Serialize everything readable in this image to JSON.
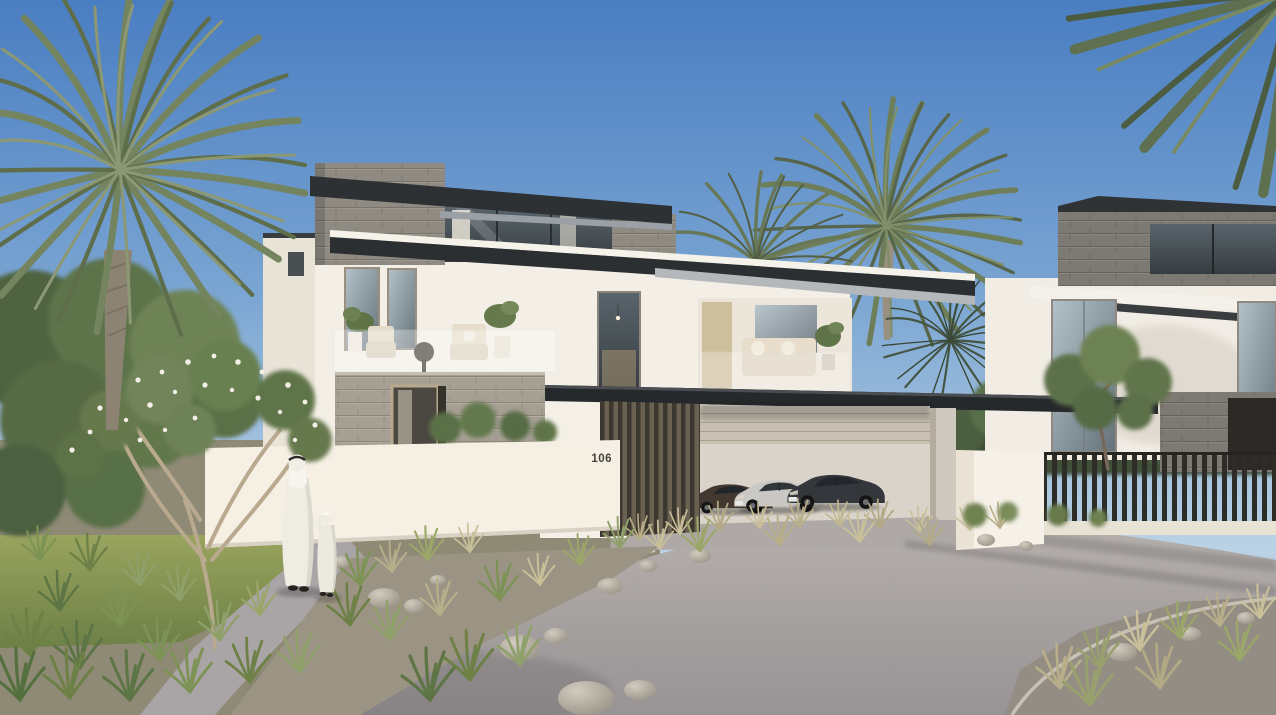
{
  "scene": {
    "title": "Modern luxury villa exterior rendering",
    "setting": "daytime, clear blue sky, palm trees, landscaped desert garden",
    "house_number": "106",
    "villa": {
      "label": "main-villa",
      "storeys": 3,
      "materials": [
        "white plaster",
        "gray stone cladding",
        "dark flat metal roofs",
        "glass balustrades",
        "timber louvers"
      ],
      "features": [
        "roof-top stone volume",
        "terrace with two chairs and round table",
        "recessed balcony with sofa",
        "tall glazing with curtains",
        "stone entry wall",
        "carport with louvered screen"
      ]
    },
    "neighbor_villa": {
      "label": "neighbor-villa",
      "materials": [
        "white plaster",
        "dark stone cladding",
        "dark flat roof"
      ],
      "fence": "dark vertical metal slat fence on white base wall"
    },
    "carport": {
      "car_count": 3,
      "cars": [
        {
          "label": "dark-brown sedan",
          "color": "#433931"
        },
        {
          "label": "silver coupe",
          "color": "#c9c8c4"
        },
        {
          "label": "dark-gray sedan",
          "color": "#33363a"
        }
      ]
    },
    "pedestrians": [
      {
        "label": "adult in white kandura with ghutra"
      },
      {
        "label": "child in white kandura, holding adult's hand"
      }
    ],
    "vegetation": {
      "palm_trees": 5,
      "flowering_tree": "tree with white blossoms on left lawn",
      "ornamental_grasses": true,
      "rocks_and_boulders": true,
      "lawn": true
    },
    "palette": {
      "sky_top": "#4a7ec2",
      "sky_horizon": "#dde9f1",
      "wall_white": "#f3efe7",
      "wall_cream": "#f6f0e5",
      "stone_gray": "#8f8b83",
      "stone_beige": "#a69f93",
      "roof_dark": "#2c2f31",
      "wood_louver": "#6b6153",
      "asphalt": "#a19c9d",
      "lawn_green": "#7d9355",
      "palm_green": "#6e7e59"
    }
  }
}
